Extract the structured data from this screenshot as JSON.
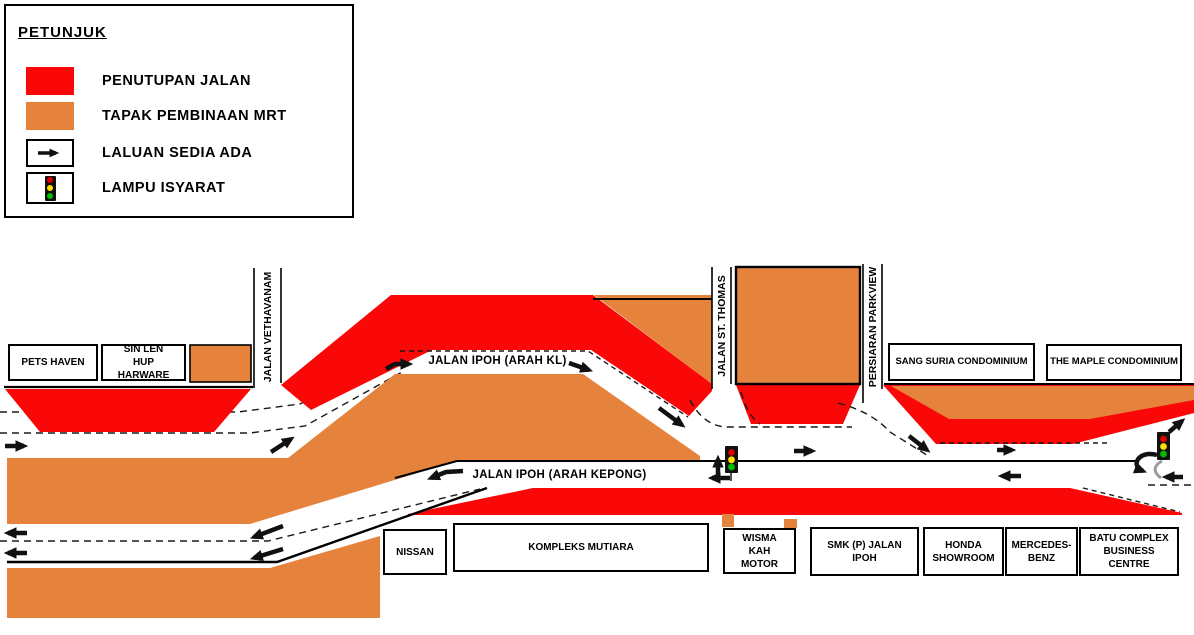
{
  "colors": {
    "closure": "#FA0707",
    "site": "#E5823C",
    "light_red": "#DD0000",
    "light_yellow": "#FFE000",
    "light_green": "#00BB00"
  },
  "legend": {
    "title": "PETUNJUK",
    "items": [
      {
        "id": "road-closure",
        "label": "PENUTUPAN JALAN"
      },
      {
        "id": "mrt-construction-site",
        "label": "TAPAK PEMBINAAN MRT"
      },
      {
        "id": "existing-route",
        "label": "LALUAN  SEDIA ADA"
      },
      {
        "id": "traffic-light",
        "label": "LAMPU ISYARAT"
      }
    ]
  },
  "map": {
    "roads": {
      "ipoh_kl": "JALAN IPOH (ARAH KL)",
      "ipoh_kepong": "JALAN IPOH (ARAH KEPONG)",
      "vethavanam": "JALAN VETHAVANAM",
      "st_thomas": "JALAN ST. THOMAS",
      "parkview": "PERSIARAN PARKVIEW"
    },
    "buildings": {
      "pets_haven": "PETS HAVEN",
      "sin_len_hup": "SIN LEN HUP HARWARE",
      "sang_suria": "SANG SURIA CONDOMINIUM",
      "maple": "THE MAPLE CONDOMINIUM",
      "nissan": "NISSAN",
      "kompleks_mutiara": "KOMPLEKS MUTIARA",
      "wisma_kah": "WISMA KAH MOTOR",
      "smk": "SMK (P) JALAN IPOH",
      "honda": "HONDA SHOWROOM",
      "mercedes": "MERCEDES- BENZ",
      "batu": "BATU COMPLEX BUSINESS CENTRE"
    }
  }
}
